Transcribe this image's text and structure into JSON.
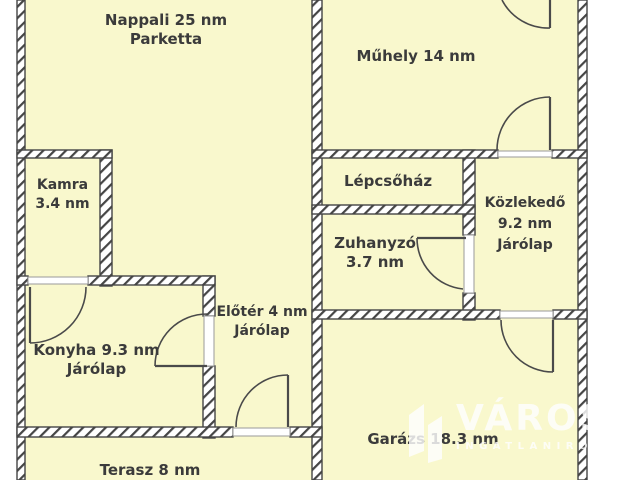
{
  "plan": {
    "rooms": {
      "nappali": {
        "lines": [
          "Nappali 25 nm",
          "Parketta"
        ]
      },
      "muhely": {
        "lines": [
          "Műhely 14 nm"
        ]
      },
      "kamra": {
        "lines": [
          "Kamra",
          "3.4 nm"
        ]
      },
      "lepcsohaz": {
        "lines": [
          "Lépcsőház"
        ]
      },
      "kozlekedo": {
        "lines": [
          "Közlekedő",
          "9.2 nm",
          "Járólap"
        ]
      },
      "zuhanyzo": {
        "lines": [
          "Zuhanyzó",
          "3.7 nm"
        ]
      },
      "eloter": {
        "lines": [
          "Előtér 4 nm",
          "Járólap"
        ]
      },
      "konyha": {
        "lines": [
          "Konyha 9.3 nm",
          "Járólap"
        ]
      },
      "garazs": {
        "lines": [
          "Garázs 18.3 nm"
        ]
      },
      "terasz": {
        "lines": [
          "Terasz 8 nm"
        ]
      }
    }
  },
  "watermark": {
    "title": "VÁROS",
    "subtitle": "INGATLANIRO",
    "icon": "city-buildings-icon"
  },
  "colors": {
    "background": "#ffffff",
    "room_fill": "#f9f8cd",
    "wall_fill": "#ffffff",
    "wall_stroke": "#454545",
    "door_stroke": "#4a4a4a",
    "label_text": "#3b3b3b",
    "watermark_color": "#ffffff"
  }
}
